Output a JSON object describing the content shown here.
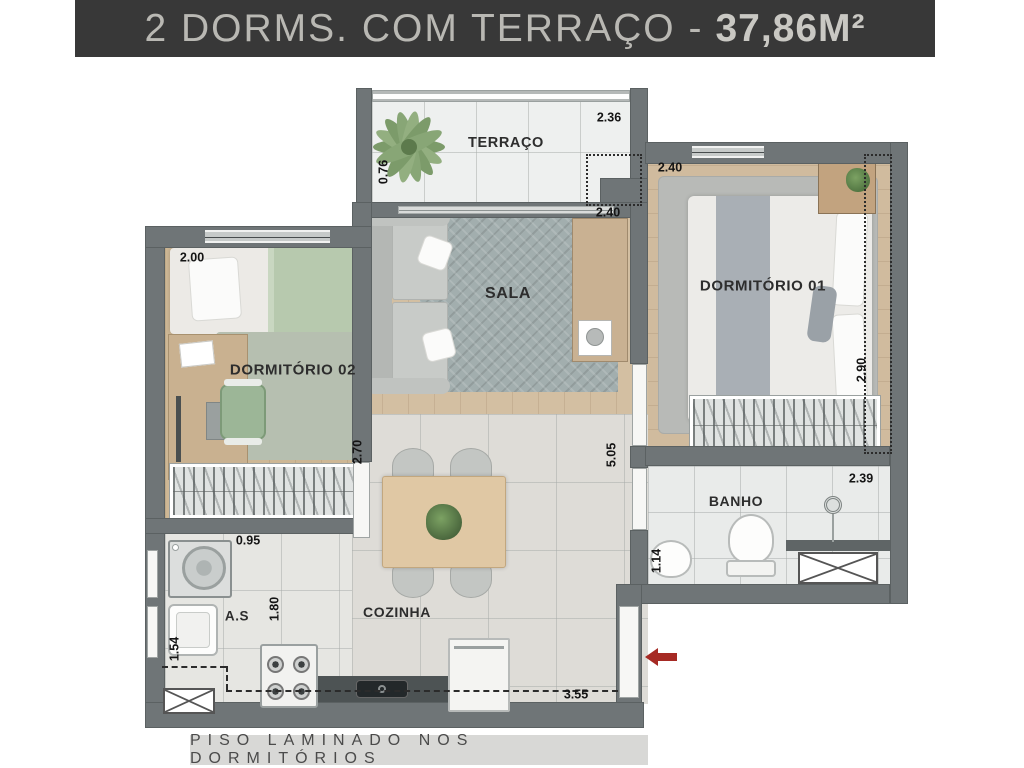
{
  "header": {
    "title": "2 DORMS. COM TERRAÇO -",
    "area": "37,86M²"
  },
  "footer": {
    "note": "PISO LAMINADO NOS DORMITÓRIOS"
  },
  "rooms": {
    "terraco": {
      "label": "TERRAÇO",
      "width": "2.36",
      "depth": "0.76"
    },
    "sala": {
      "label": "SALA",
      "width": "2.40"
    },
    "dorm1": {
      "label": "DORMITÓRIO 01",
      "width": "2.40",
      "depth": "2.90"
    },
    "dorm2": {
      "label": "DORMITÓRIO 02",
      "width": "2.00",
      "depth": "2.70"
    },
    "banho": {
      "label": "BANHO",
      "width": "2.39",
      "depth": "1.14"
    },
    "cozinha": {
      "label": "COZINHA",
      "width": "3.55",
      "length": "5.05"
    },
    "as": {
      "label": "A.S",
      "width": "0.95",
      "depth": "1.80",
      "height": "1.54"
    }
  },
  "colors": {
    "header_bg": "#383838",
    "header_text": "#b9b8b3",
    "wall": "#6f7577",
    "arrow": "#a62a24",
    "wood": "#d2bda0",
    "sala_rug": "#a2aeae",
    "footer_bg": "#d8d8d6"
  }
}
